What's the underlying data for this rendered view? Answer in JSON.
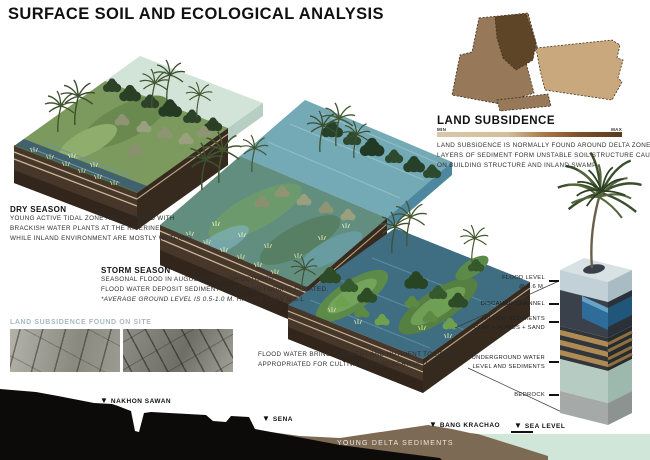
{
  "title": "SURFACE SOIL AND ECOLOGICAL ANALYSIS",
  "dry_season": {
    "heading": "DRY SEASON",
    "line1": "YOUNG ACTIVE TIDAL ZONE ARE COVERED WITH",
    "line2": "BRACKISH WATER PLANTS AT THE RIVERINE.",
    "line3": "WHILE INLAND ENVIRONMENT ARE MOSTLY WETLAND."
  },
  "storm_season": {
    "heading": "STORM SEASON",
    "line1": "SEASONAL FLOOD IN AUGUST THROUGH OCTOBER.",
    "line2": "FLOOD WATER DEPOSIT SEDIMENT WHAT LAND FORM IS CREATED.",
    "line3": "*AVERAGE GROUND LEVEL IS 0.5-1.0 M. HIGHER THAN M.S.L"
  },
  "flood_note": {
    "line1": "FLOOD WATER BRING SEDIMENT AND NUTRIENT TO DELTA.",
    "line2": "APPROPRIATED FOR CULTIVATION AND AGRICULTURE."
  },
  "land_subsidence": {
    "heading": "LAND SUBSIDENCE",
    "scale_min": "MIN",
    "scale_max": "MAX",
    "line1": "LAND SUBSIDENCE IS NORMALLY FOUND AROUND DELTA ZONE",
    "line2": "LAYERS OF SEDIMENT  FORM UNSTABLE SOIL STRUCTURE CAUSES DAMAGE",
    "line3": "ON BUILDING STRUCTURE AND INLAND SWAMP."
  },
  "site_photos": {
    "heading": "LAND SUBSIDENCE FOUND  ON  SITE"
  },
  "soil_column": {
    "labels": [
      {
        "line1": "FLOOD LEVEL",
        "line2": "@ 0.6 M."
      },
      {
        "line1": "DISCAHRD CHANNEL"
      },
      {
        "line1": "FLOOD SEDIMENTS",
        "line2": "CLAY + HUMUS + SAND"
      },
      {
        "line1": "UNDERGROUND WATER",
        "line2": "LEVEL AND SEDIMENTS"
      },
      {
        "line1": "BEDROCK"
      }
    ]
  },
  "cross_section": {
    "markers": [
      {
        "label": "NAKHON SAWAN"
      },
      {
        "label": "SENA"
      },
      {
        "label": "BANG KRACHAO"
      },
      {
        "label": "SEA LEVEL"
      }
    ],
    "band_label": "YOUNG DELTA SEDIMENTS"
  },
  "colors": {
    "scale_min": "#d8c8aa",
    "scale_max": "#5a3a1e",
    "photo_caption": "#a8b9c2",
    "sea": "#cfe6d9",
    "delta_sediment": "#7c6a55"
  }
}
